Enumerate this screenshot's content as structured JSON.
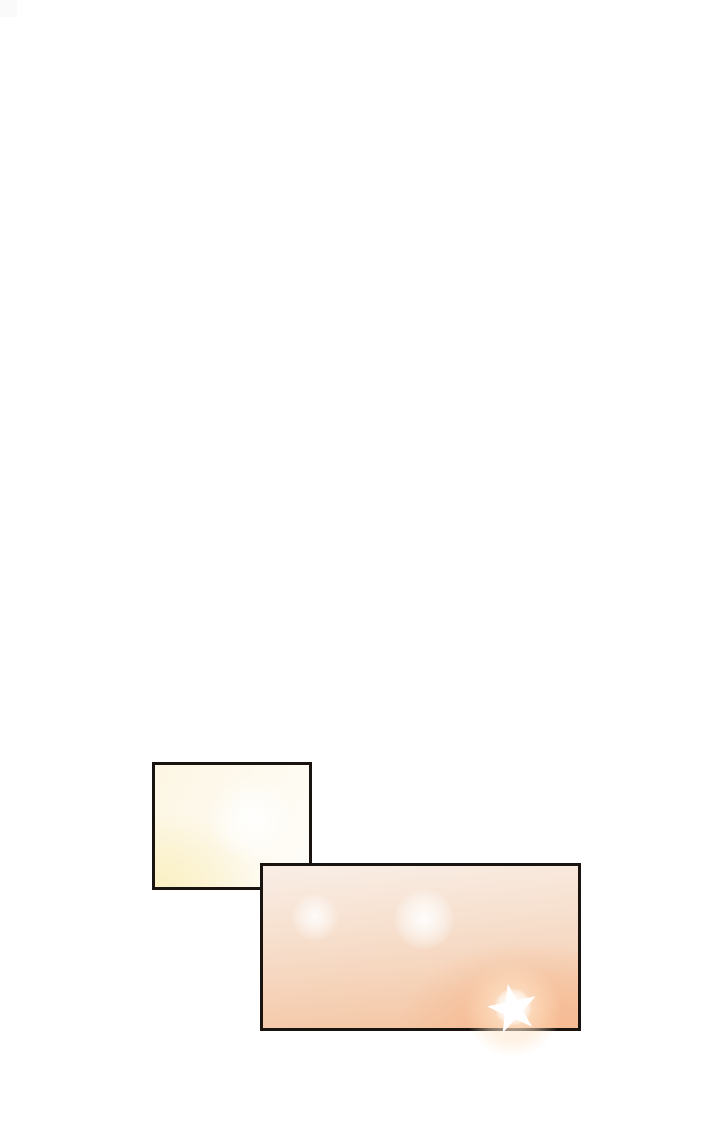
{
  "page": {
    "kind": "comic-page",
    "text": ""
  },
  "colors": {
    "page-bg": "#ffffff",
    "artifact-gray": "#fafafa",
    "panel-border": "#1a1410",
    "p1-base": "#fdf6e4",
    "p1-light": "#fefdf8",
    "p1-yellow": "#faefc0",
    "p2-top": "#f9eee6",
    "p2-mid": "#f6dcc8",
    "p2-bottom": "#f4c4a1",
    "p2-corner": "#f6b88f",
    "glow-white": "#ffffff",
    "star-halo": "#ffe9d2"
  }
}
